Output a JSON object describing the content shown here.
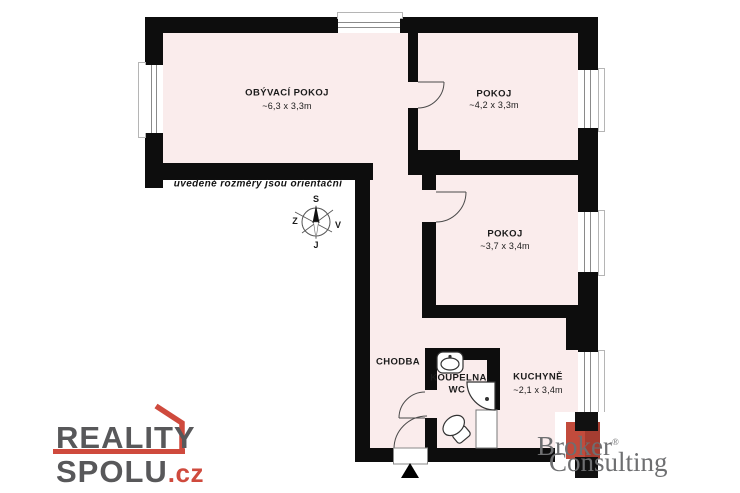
{
  "plan": {
    "note": "uvedené rozměry jsou orientační",
    "rooms": {
      "living": {
        "name": "OBÝVACÍ POKOJ",
        "dims": "~6,3 x 3,3m"
      },
      "pokoj1": {
        "name": "POKOJ",
        "dims": "~4,2 x 3,3m"
      },
      "pokoj2": {
        "name": "POKOJ",
        "dims": "~3,7 x 3,4m"
      },
      "chodba": {
        "name": "CHODBA"
      },
      "koupelna": {
        "name": "KOUPELNA,",
        "name2": "WC"
      },
      "kuchyne": {
        "name": "KUCHYNĚ",
        "dims": "~2,1 x 3,4m"
      }
    },
    "compass": {
      "north": "S",
      "south": "J",
      "west": "Z",
      "east": "V"
    }
  },
  "branding": {
    "reality_spolu": {
      "line1": "REALITY",
      "line2": "SPOLU",
      "tld": ".cz"
    },
    "broker_consulting": {
      "line1": "Broker",
      "registered": "®",
      "line2": "Consulting"
    }
  },
  "colors": {
    "wall": "#0d0d0d",
    "floor": "#faecec",
    "reality_gray": "#58585a",
    "reality_red": "#cf4a3d",
    "broker_gray": "#6e6f71",
    "broker_red": "#c24b3c"
  }
}
